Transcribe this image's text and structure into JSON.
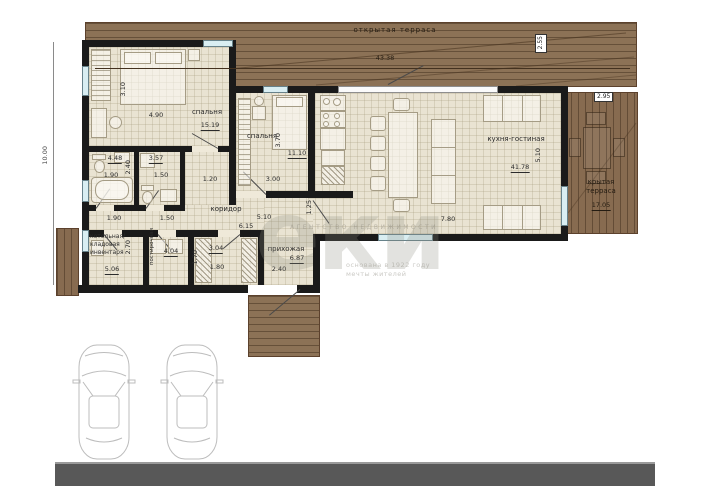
{
  "watermark": {
    "brand": "АГЕНТСТВО НЕДВИЖИМОСТИ",
    "logo": "еки",
    "sub1": "основана в 1922 году",
    "sub2": "мечты жителей"
  },
  "dims": {
    "overall_height": "10.00"
  },
  "terrace_top": {
    "label": "открытая терраса",
    "length": "43.38",
    "depth": "2.55"
  },
  "terrace_right": {
    "label1": "крытая",
    "label2": "терраса",
    "area": "17.05",
    "width": "2.95"
  },
  "rooms": {
    "bedroom1": {
      "name": "спальня",
      "area": "15.19",
      "width": "4.90",
      "height": "3.10"
    },
    "bedroom2": {
      "name": "спальня",
      "area": "11.10",
      "height": "3.70",
      "width": "3.00"
    },
    "living": {
      "name": "кухня-гостиная",
      "area": "41.78",
      "height": "5.10",
      "width": "7.80"
    },
    "bath1": {
      "area": "4.48",
      "width": "1.90",
      "height": "2.40"
    },
    "bath2": {
      "area": "3.57",
      "width": "1.50"
    },
    "passage": {
      "width": "1.20"
    },
    "corridor": {
      "name": "коридор",
      "dim1": "5.10",
      "dim2": "6.15",
      "dim3": "1.25"
    },
    "boiler": {
      "name1": "котельная/",
      "name2": "кладовая",
      "name3": "инвентаря",
      "area": "5.06",
      "height": "2.70",
      "width_top": "1.90"
    },
    "laundry": {
      "name": "постирочная",
      "area": "4.04",
      "width_top": "1.50"
    },
    "wardrobe": {
      "area": "3.04",
      "width": "1.80",
      "height": "1.70"
    },
    "hall": {
      "name": "прихожая",
      "area": "6.87",
      "width": "2.40"
    }
  },
  "colors": {
    "wood": "#8c7256",
    "wood_covered": "#876b50",
    "room_fill": "#e9e3d2",
    "wall": "#1a1a1a",
    "window": "#d9eef2",
    "road": "#585858"
  }
}
